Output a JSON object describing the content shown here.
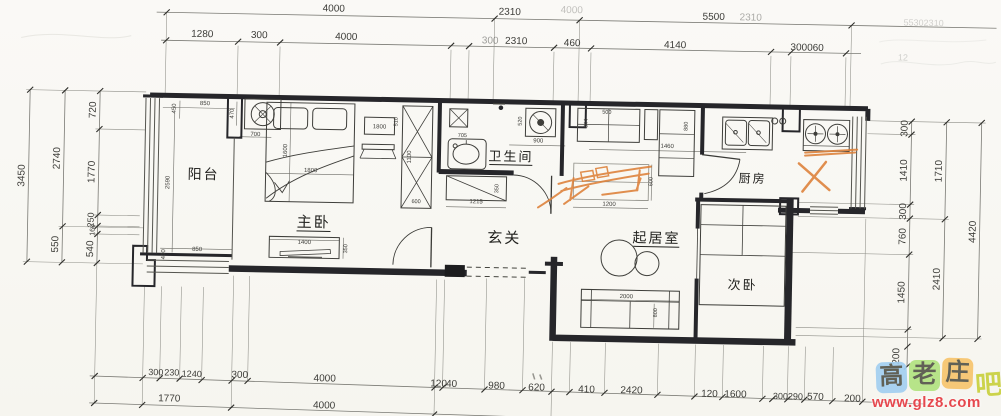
{
  "document_title": "apartment floor plan scan",
  "colors": {
    "paper": "#f9f8f4",
    "wall_ink": "#26262a",
    "thin_ink": "#4a4a46",
    "dim_line": "#7a7a74",
    "sketch_orange": "#dd8038",
    "watermark_blue": "#a3cff1",
    "watermark_green": "#b2e381",
    "watermark_orange": "#f7c56d",
    "watermark_ba_yellow": "#ccd34b",
    "watermark_url_red": "#e6484e"
  },
  "rooms": [
    {
      "label": "阳台",
      "x": 205,
      "y": 178,
      "size": 14
    },
    {
      "label": "主卧",
      "x": 316,
      "y": 224,
      "size": 15,
      "u": true
    },
    {
      "label": "卫生间",
      "x": 512,
      "y": 154,
      "size": 13,
      "u": true
    },
    {
      "label": "玄关",
      "x": 507,
      "y": 236,
      "size": 15
    },
    {
      "label": "起居室",
      "x": 659,
      "y": 233,
      "size": 14,
      "u": true
    },
    {
      "label": "次卧",
      "x": 746,
      "y": 278,
      "size": 13
    },
    {
      "label": "厨房",
      "x": 754,
      "y": 171,
      "size": 12
    }
  ],
  "dim_labels": [
    {
      "t": "4000",
      "x": 332,
      "y": 8,
      "s": 10
    },
    {
      "t": "2310",
      "x": 508,
      "y": 8,
      "s": 10
    },
    {
      "t": "4000",
      "x": 570,
      "y": 5,
      "s": 10,
      "o": 0.3
    },
    {
      "t": "5500",
      "x": 712,
      "y": 9,
      "s": 10
    },
    {
      "t": "2310",
      "x": 749,
      "y": 9,
      "s": 10,
      "o": 0.42
    },
    {
      "t": "55302310",
      "x": 922,
      "y": 11,
      "s": 9,
      "o": 0.22
    },
    {
      "t": "1280",
      "x": 201,
      "y": 36,
      "s": 10
    },
    {
      "t": "300",
      "x": 258,
      "y": 36,
      "s": 10
    },
    {
      "t": "4000",
      "x": 345,
      "y": 36,
      "s": 10
    },
    {
      "t": "300",
      "x": 489,
      "y": 37,
      "s": 10,
      "o": 0.5
    },
    {
      "t": "2310",
      "x": 515,
      "y": 37,
      "s": 10
    },
    {
      "t": "460",
      "x": 571,
      "y": 38,
      "s": 10
    },
    {
      "t": "4140",
      "x": 674,
      "y": 38,
      "s": 10
    },
    {
      "t": "300060",
      "x": 806,
      "y": 38,
      "s": 10
    },
    {
      "t": "12",
      "x": 902,
      "y": 46,
      "s": 9,
      "o": 0.22
    },
    {
      "t": "3450",
      "x": 26,
      "y": 178,
      "s": 10,
      "r": true
    },
    {
      "t": "2740",
      "x": 61,
      "y": 160,
      "s": 10,
      "r": true
    },
    {
      "t": "550",
      "x": 61,
      "y": 246,
      "s": 10,
      "r": true
    },
    {
      "t": "720",
      "x": 96,
      "y": 111,
      "s": 10,
      "r": true
    },
    {
      "t": "1770",
      "x": 96,
      "y": 173,
      "s": 10,
      "r": true
    },
    {
      "t": "250",
      "x": 96,
      "y": 221,
      "s": 9,
      "r": true
    },
    {
      "t": "160",
      "x": 97,
      "y": 231,
      "s": 7,
      "r": true
    },
    {
      "t": "540",
      "x": 96,
      "y": 250,
      "s": 10,
      "r": true
    },
    {
      "t": "300",
      "x": 908,
      "y": 114,
      "s": 10,
      "r": true
    },
    {
      "t": "1410",
      "x": 908,
      "y": 156,
      "s": 10,
      "r": true
    },
    {
      "t": "300",
      "x": 908,
      "y": 197,
      "s": 10,
      "r": true
    },
    {
      "t": "760",
      "x": 908,
      "y": 222,
      "s": 10,
      "r": true
    },
    {
      "t": "1450",
      "x": 908,
      "y": 278,
      "s": 10,
      "r": true
    },
    {
      "t": "200",
      "x": 904,
      "y": 342,
      "s": 10,
      "r": true
    },
    {
      "t": "1710",
      "x": 943,
      "y": 156,
      "s": 10,
      "r": true
    },
    {
      "t": "2410",
      "x": 943,
      "y": 264,
      "s": 10,
      "r": true
    },
    {
      "t": "4420",
      "x": 978,
      "y": 216,
      "s": 10,
      "r": true
    },
    {
      "t": "300",
      "x": 161,
      "y": 375,
      "s": 9
    },
    {
      "t": "230",
      "x": 177,
      "y": 375,
      "s": 9
    },
    {
      "t": "1240",
      "x": 197,
      "y": 376,
      "s": 9
    },
    {
      "t": "300",
      "x": 245,
      "y": 376,
      "s": 10
    },
    {
      "t": "4000",
      "x": 330,
      "y": 378,
      "s": 10
    },
    {
      "t": "120",
      "x": 444,
      "y": 381,
      "s": 10
    },
    {
      "t": "40",
      "x": 457,
      "y": 381,
      "s": 10
    },
    {
      "t": "980",
      "x": 502,
      "y": 382,
      "s": 10
    },
    {
      "t": "620",
      "x": 542,
      "y": 383,
      "s": 10
    },
    {
      "t": "410",
      "x": 592,
      "y": 384,
      "s": 10
    },
    {
      "t": "2420",
      "x": 637,
      "y": 384,
      "s": 10
    },
    {
      "t": "120",
      "x": 715,
      "y": 386,
      "s": 10
    },
    {
      "t": "1600",
      "x": 741,
      "y": 386,
      "s": 10
    },
    {
      "t": "300",
      "x": 786,
      "y": 387,
      "s": 9
    },
    {
      "t": "290",
      "x": 801,
      "y": 387,
      "s": 9
    },
    {
      "t": "570",
      "x": 821,
      "y": 387,
      "s": 10
    },
    {
      "t": "200",
      "x": 858,
      "y": 388,
      "s": 10
    },
    {
      "t": "1770",
      "x": 175,
      "y": 401,
      "s": 10
    },
    {
      "t": "4000",
      "x": 330,
      "y": 405,
      "s": 10
    },
    {
      "t": "450",
      "x": 176,
      "y": 108,
      "s": 6,
      "r": true
    },
    {
      "t": "850",
      "x": 205,
      "y": 104,
      "s": 6
    },
    {
      "t": "470",
      "x": 234,
      "y": 112,
      "s": 6,
      "r": true
    },
    {
      "t": "700",
      "x": 256,
      "y": 134,
      "s": 6
    },
    {
      "t": "2590",
      "x": 171,
      "y": 182,
      "s": 6,
      "r": true
    },
    {
      "t": "850",
      "x": 200,
      "y": 250,
      "s": 6
    },
    {
      "t": "430",
      "x": 168,
      "y": 254,
      "s": 6,
      "r": true
    },
    {
      "t": "1600",
      "x": 288,
      "y": 148,
      "s": 6,
      "r": true
    },
    {
      "t": "1800",
      "x": 312,
      "y": 169,
      "s": 6
    },
    {
      "t": "1800",
      "x": 380,
      "y": 124,
      "s": 6
    },
    {
      "t": "510",
      "x": 398,
      "y": 117,
      "s": 5.5,
      "r": true
    },
    {
      "t": "1100",
      "x": 412,
      "y": 152,
      "s": 6,
      "r": true
    },
    {
      "t": "600",
      "x": 418,
      "y": 198,
      "s": 5.5
    },
    {
      "t": "1400",
      "x": 307,
      "y": 241,
      "s": 6
    },
    {
      "t": "350",
      "x": 350,
      "y": 245,
      "s": 5.5,
      "r": true
    },
    {
      "t": "705",
      "x": 463,
      "y": 131,
      "s": 5.5
    },
    {
      "t": "520",
      "x": 522,
      "y": 114,
      "s": 5.5,
      "r": true
    },
    {
      "t": "900",
      "x": 539,
      "y": 135,
      "s": 6
    },
    {
      "t": "350",
      "x": 500,
      "y": 182,
      "s": 5.5,
      "r": true
    },
    {
      "t": "1215",
      "x": 478,
      "y": 197,
      "s": 6
    },
    {
      "t": "500",
      "x": 607,
      "y": 105,
      "s": 5.5
    },
    {
      "t": "644",
      "x": 588,
      "y": 115,
      "s": 5.5,
      "r": true
    },
    {
      "t": "880",
      "x": 688,
      "y": 116,
      "s": 5.5,
      "r": true
    },
    {
      "t": "1460",
      "x": 668,
      "y": 138,
      "s": 6
    },
    {
      "t": "1200",
      "x": 611,
      "y": 197,
      "s": 6
    },
    {
      "t": "600",
      "x": 654,
      "y": 172,
      "s": 5.5,
      "r": true
    },
    {
      "t": "2000",
      "x": 630,
      "y": 289,
      "s": 6
    },
    {
      "t": "800",
      "x": 661,
      "y": 303,
      "s": 5.5,
      "r": true
    }
  ],
  "watermark": {
    "chars": [
      {
        "ch": "高",
        "bg": "#a3cff1"
      },
      {
        "ch": "老",
        "bg": "#b2e381"
      },
      {
        "ch": "庄",
        "bg": "#f7c56d"
      }
    ],
    "suffix": "吧",
    "url": "www.glz8.com"
  }
}
